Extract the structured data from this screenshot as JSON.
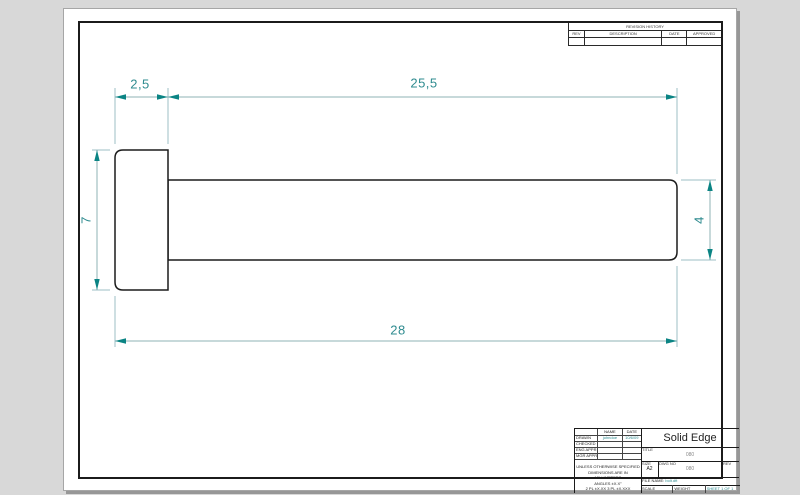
{
  "colors": {
    "dimension_accent": "#0b8484",
    "dimension_text": "#2e8b8f",
    "extension_line": "#9dbfc4",
    "part_line": "#1b1b1b",
    "sheet": "#ffffff",
    "background": "#d8d8d8"
  },
  "revision_table": {
    "title": "REVISION HISTORY",
    "columns": [
      "REV",
      "DESCRIPTION",
      "DATE",
      "APPROVED"
    ]
  },
  "dims": {
    "head_width": "2,5",
    "shaft_length": "25,5",
    "head_height": "7",
    "shaft_diameter": "4",
    "total_length": "28"
  },
  "title_block": {
    "name_header": "NAME",
    "date_header": "DATE",
    "sign_rows": [
      {
        "label": "DRAWN",
        "name": "johndoe",
        "date": "10/6/09"
      },
      {
        "label": "CHECKED",
        "name": "",
        "date": ""
      },
      {
        "label": "ENG APPR",
        "name": "",
        "date": ""
      },
      {
        "label": "MGR APPR",
        "name": "",
        "date": ""
      }
    ],
    "notes": [
      "UNLESS OTHERWISE SPECIFIED",
      "DIMENSIONS ARE IN MILLIMETERS",
      "ANGLES ±X.X°",
      "2 PL ±X.XX 3 PL ±X.XXX"
    ],
    "brand": "Solid Edge",
    "title_label": "TITLE",
    "title_value": "080",
    "size_label": "SIZE",
    "size_value": "A2",
    "dwg_label": "DWG NO",
    "dwg_value": "080",
    "rev_label": "REV",
    "rev_value": "",
    "file_label": "FILE NAME:",
    "file_value": "bolt.dft",
    "scale_label": "SCALE",
    "weight_label": "WEIGHT",
    "sheet_value": "SHEET 1 OF 1"
  }
}
